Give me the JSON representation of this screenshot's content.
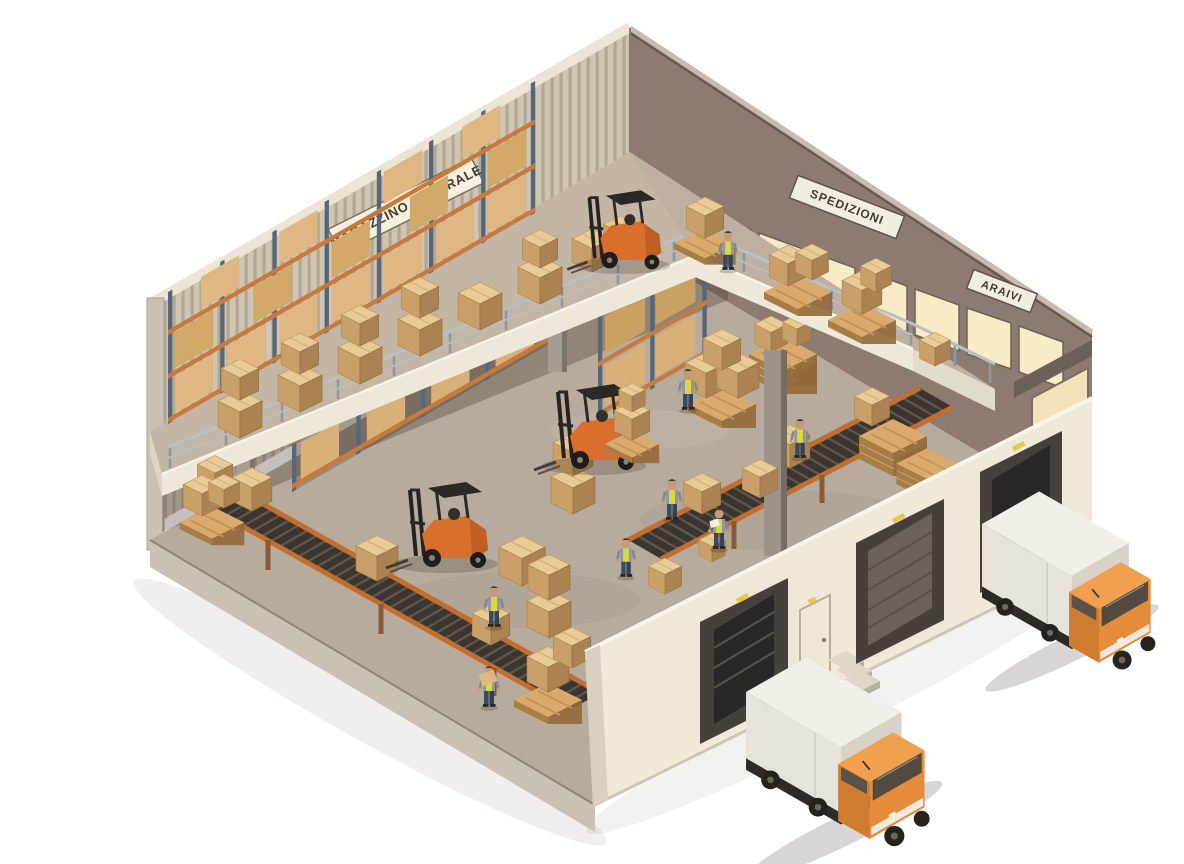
{
  "scene": {
    "type": "isometric-warehouse-illustration",
    "background": "#ffffff",
    "signs": {
      "left_wall": "MAGAZZINO CENTRALE",
      "right_wall_upper": "SPEDIZIONI",
      "right_wall_lower": "ARAIVI"
    },
    "counts": {
      "workers": 8,
      "forklifts": 3,
      "trucks": 2,
      "dock_doors": 3,
      "conveyor_lines": 2,
      "window_panes": 8
    },
    "palette": {
      "wall_left": "#cfc5b3",
      "wall_left_stripe": "#b3a794",
      "wall_right": "#8d7b72",
      "wall_front": "#f0e9da",
      "floor": "#b7ab9d",
      "mezzanine": "#c3b6a5",
      "window_glow": "#f8ebc6",
      "box_top": "#e9cb96",
      "box_left": "#caa06a",
      "box_right": "#ab8352",
      "rack_post": "#56677c",
      "rack_beam": "#c8793c",
      "conveyor_frame": "#c26e31",
      "conveyor_belt": "#3b352f",
      "forklift": "#d96f2c",
      "truck_cab": "#e48c3a",
      "truck_box": "#f2efe9",
      "vest": "#d9d93f",
      "railing": "#b9bfc6",
      "dock_shelter": "#46403a"
    }
  }
}
